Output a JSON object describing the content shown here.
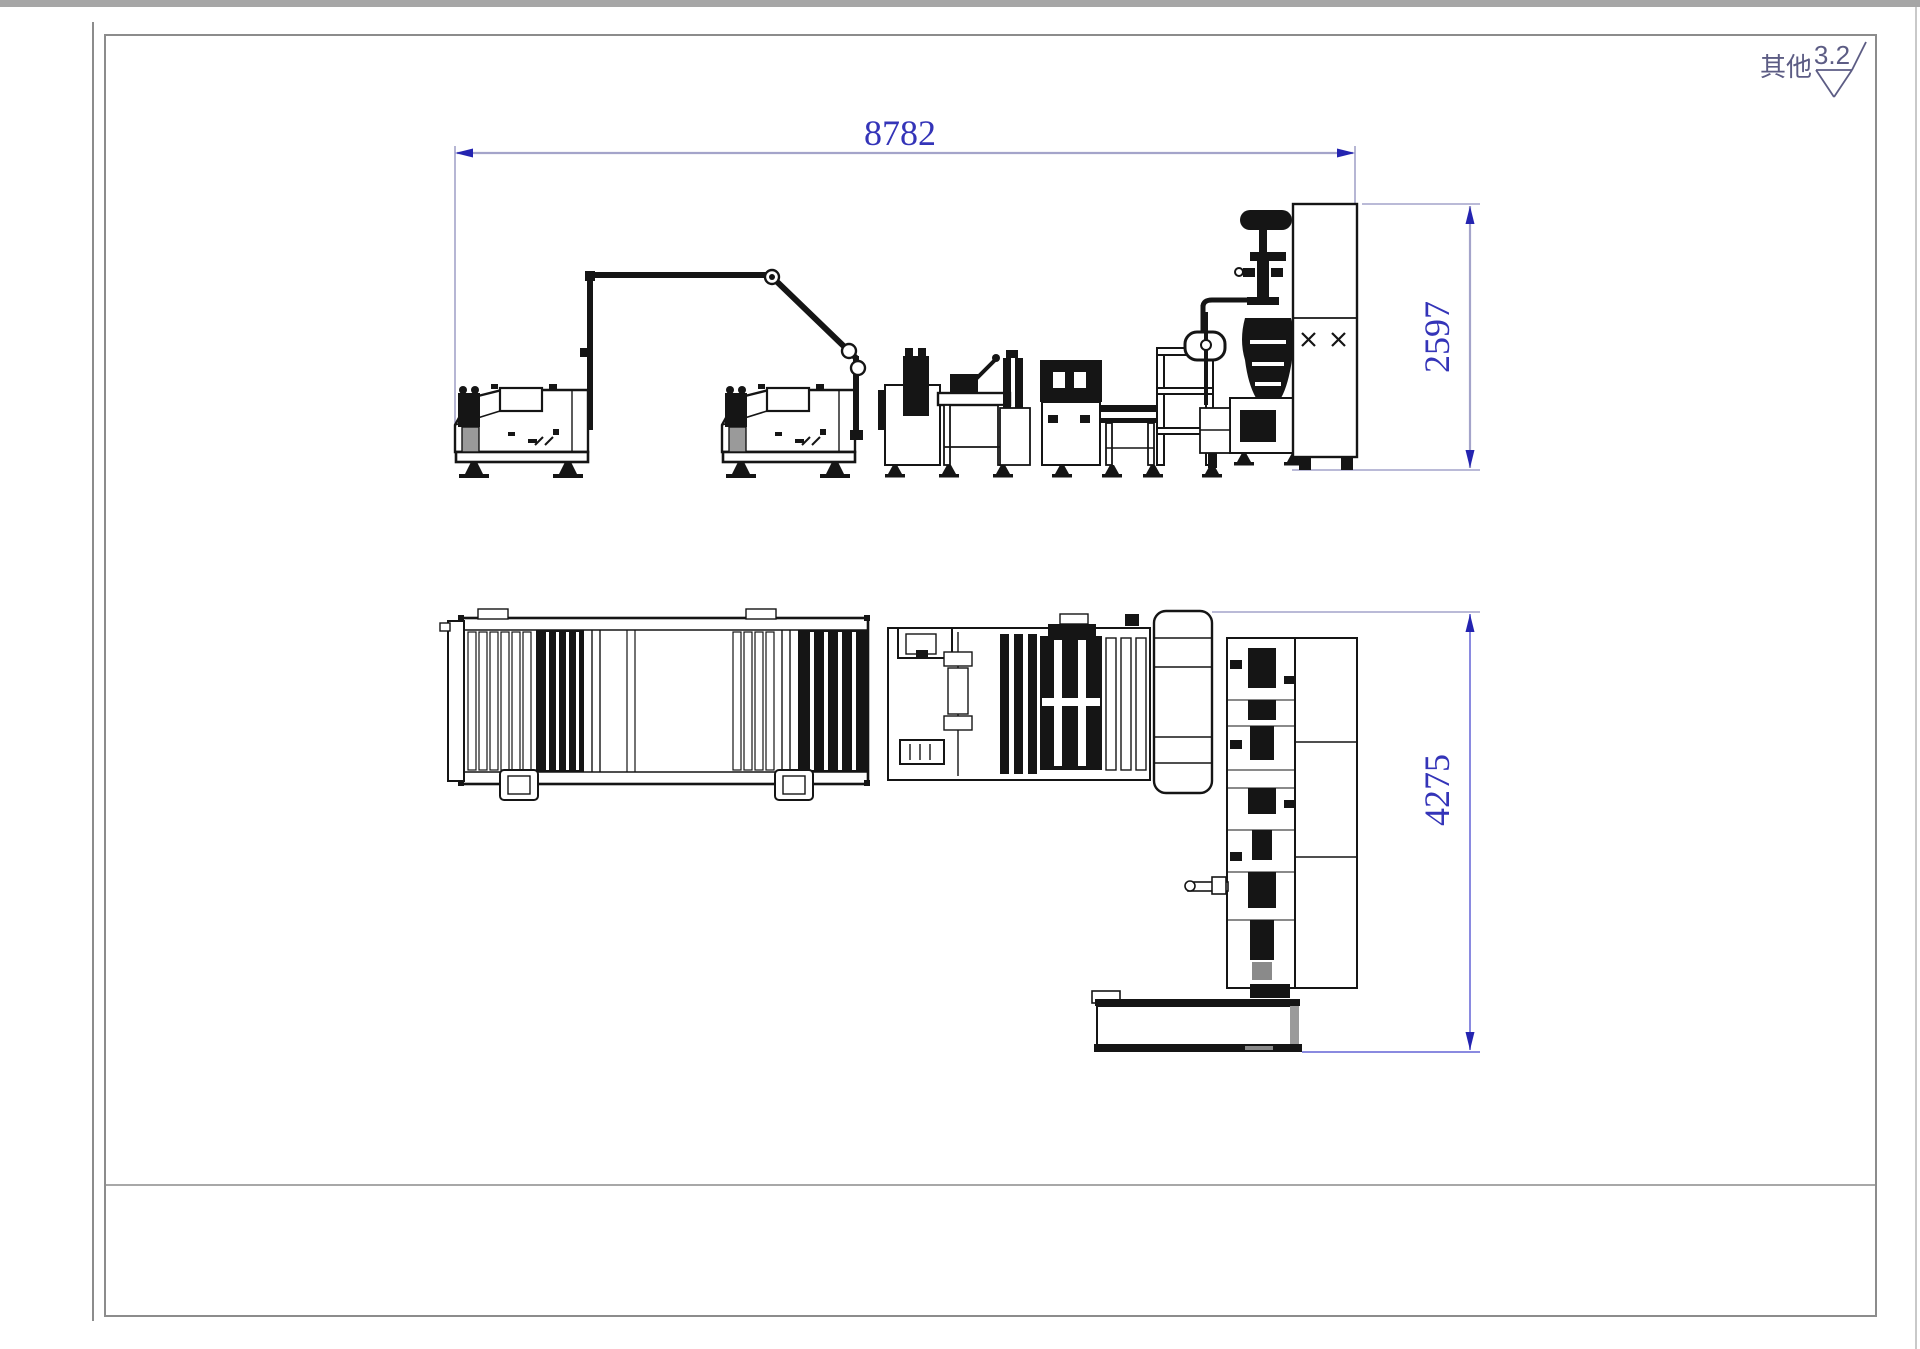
{
  "annotations": {
    "other_label": "其他",
    "roughness_value": "3.2"
  },
  "dimensions": {
    "overall_width": "8782",
    "machine_height": "2597",
    "layout_depth": "4275"
  },
  "colors": {
    "dimension_text": "#3434b8",
    "dimension_arrow": "#2424b0",
    "dimension_line": "#a4a4ca",
    "annotation_ink": "#5c5c84",
    "machine_ink": "#151515",
    "frame_line": "#8c8c8c"
  }
}
